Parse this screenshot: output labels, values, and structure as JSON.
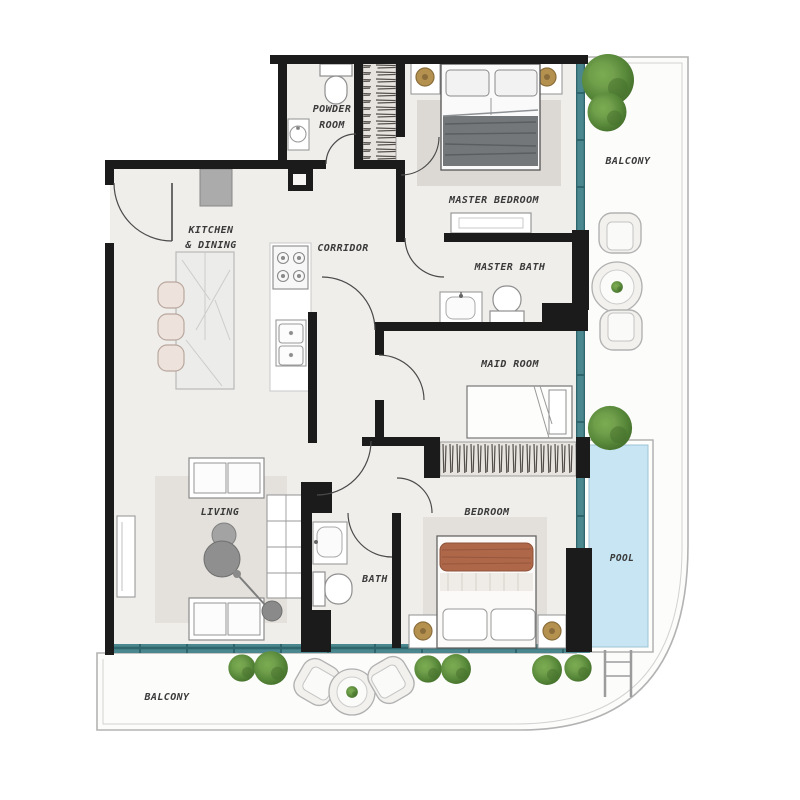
{
  "rooms": {
    "powder_room": {
      "label_line1": "POWDER",
      "label_line2": "ROOM"
    },
    "kitchen_dining": {
      "label_line1": "KITCHEN",
      "label_line2": "& DINING"
    },
    "corridor": {
      "label": "CORRIDOR"
    },
    "master_bedroom": {
      "label": "MASTER BEDROOM"
    },
    "master_bath": {
      "label": "MASTER BATH"
    },
    "maid_room": {
      "label": "MAID ROOM"
    },
    "living": {
      "label": "LIVING"
    },
    "bath": {
      "label": "BATH"
    },
    "bedroom": {
      "label": "BEDROOM"
    },
    "balcony_upper": {
      "label": "BALCONY"
    },
    "balcony_lower": {
      "label": "BALCONY"
    },
    "pool": {
      "label": "POOL"
    }
  },
  "colors": {
    "wall": "#1b1b1b",
    "floor": "#f0eeeb",
    "balcony_floor": "#fcfcfb",
    "window_glazing": "#4a878f",
    "pool_water": "#c7e5f3",
    "label_text": "#3a3a3a",
    "plant": "#5b8c3c",
    "terracotta_blanket": "#ae6749",
    "lamp_gold": "#b5914f"
  }
}
